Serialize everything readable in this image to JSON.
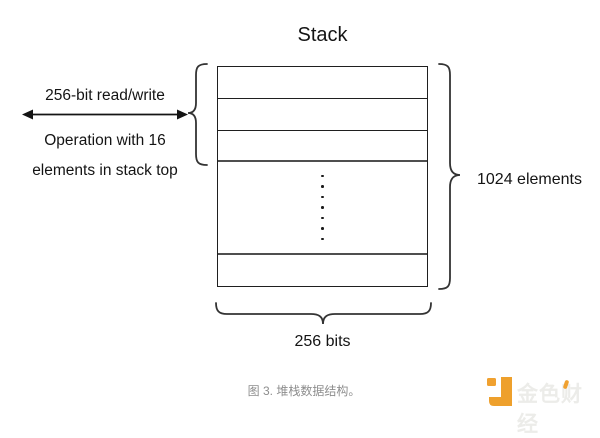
{
  "diagram": {
    "title": "Stack",
    "left_annotation": {
      "line1": "256-bit read/write",
      "line2": "Operation with 16",
      "line3": "elements in stack top"
    },
    "right_label": "1024 elements",
    "bottom_label": "256 bits",
    "structure": {
      "top_rows": 3,
      "bottom_rows": 1,
      "dots_count": 7
    }
  },
  "caption": "图 3. 堆栈数据结构。",
  "watermark": {
    "brand": "金色财经"
  },
  "colors": {
    "line": "#1f1f1f",
    "thick_line": "#4f4f4f",
    "text": "#141414",
    "caption_gray": "#8d8d8d",
    "brand_orange": "#F0A130",
    "brand_text_gray": "#ECECE9"
  }
}
